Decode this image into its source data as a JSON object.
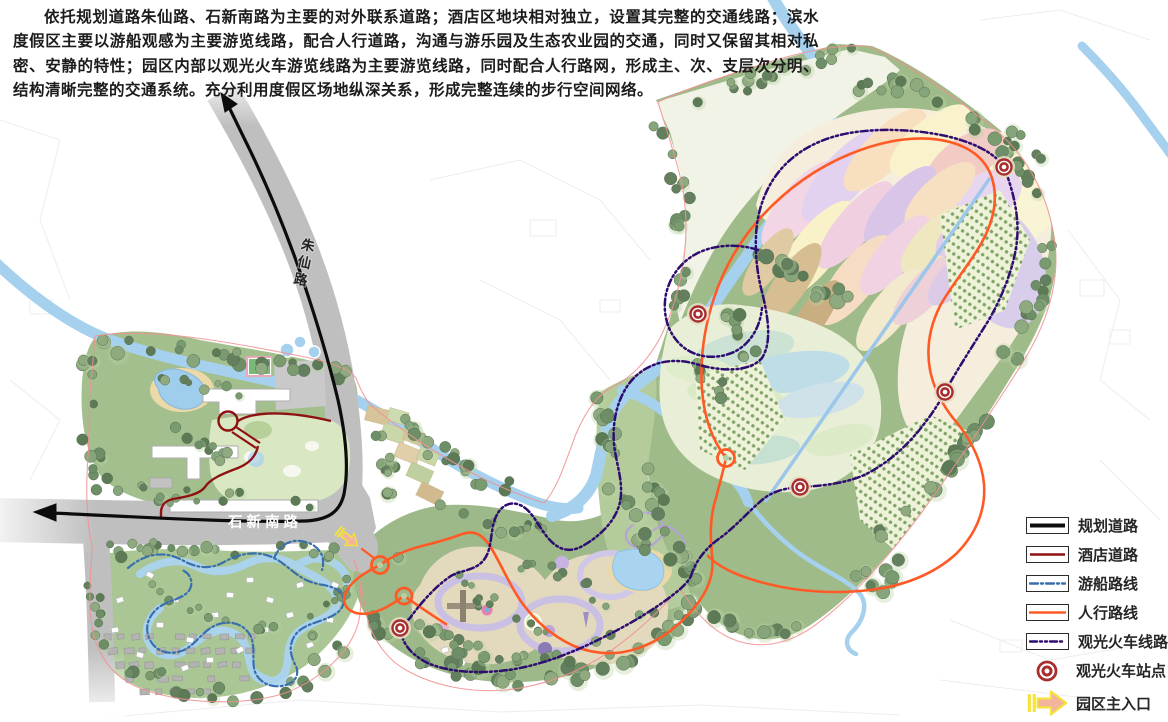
{
  "description_paragraph": "依托规划道路朱仙路、石新南路为主要的对外联系道路；酒店区地块相对独立，设置其完整的交通线路；滨水度假区主要以游船观感为主要游览线路，配合人行道路，沟通与游乐园及生态农业园的交通，同时又保留其相对私密、安静的特性；园区内部以观光火车游览线路为主要游览线路，同时配合人行路网，形成主、次、支层次分明、结构清晰完整的交通系统。充分利用度假区场地纵深关系，形成完整连续的步行空间网络。",
  "map": {
    "labels": {
      "zhuxian_road": "朱仙路",
      "shixin_south_road": "石新南路"
    }
  },
  "legend": {
    "items": [
      {
        "id": "planning-road",
        "label": "规划道路",
        "symbol": "solid-line"
      },
      {
        "id": "hotel-road",
        "label": "酒店道路",
        "symbol": "solid-line"
      },
      {
        "id": "boat-route",
        "label": "游船路线",
        "symbol": "dashdot-line"
      },
      {
        "id": "pedestrian-route",
        "label": "人行路线",
        "symbol": "solid-line"
      },
      {
        "id": "train-route",
        "label": "观光火车线路",
        "symbol": "dashdot-line"
      },
      {
        "id": "train-station",
        "label": "观光火车站点",
        "symbol": "double-circle"
      },
      {
        "id": "main-entrance",
        "label": "园区主入口",
        "symbol": "arrow"
      }
    ]
  },
  "colors": {
    "planning": "#0c0c0c",
    "hotel": "#8e1212",
    "boat": "#3a6fae",
    "ped": "#ff5a26",
    "train": "#2d0d70",
    "station": "#a82e2e",
    "entfill": "#f2b49c",
    "entstroke": "#f5e23a"
  }
}
